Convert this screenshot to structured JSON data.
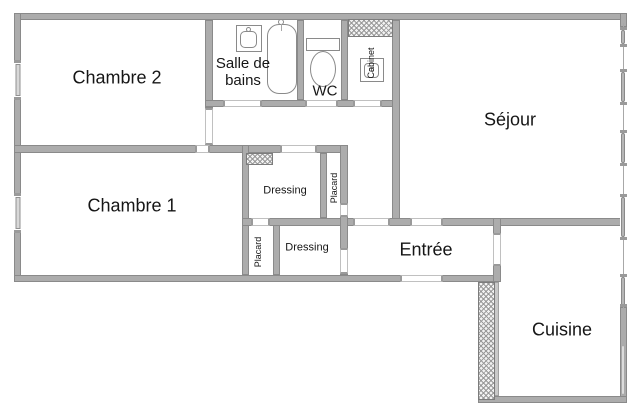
{
  "floorplan": {
    "rooms": {
      "chambre2": {
        "label": "Chambre 2"
      },
      "salle_de_bains": {
        "label_line1": "Salle de",
        "label_line2": "bains"
      },
      "wc": {
        "label": "WC"
      },
      "cabinet": {
        "label": "Cabinet"
      },
      "sejour": {
        "label": "Séjour"
      },
      "chambre1": {
        "label": "Chambre 1"
      },
      "dressing_top": {
        "label": "Dressing"
      },
      "placard_top": {
        "label": "Placard"
      },
      "placard_bottom": {
        "label": "Placard"
      },
      "dressing_bottom": {
        "label": "Dressing"
      },
      "entree": {
        "label": "Entrée"
      },
      "cuisine": {
        "label": "Cuisine"
      }
    },
    "fixtures": [
      {
        "icon": "washbasin-icon",
        "room": "salle_de_bains"
      },
      {
        "icon": "bathtub-icon",
        "room": "salle_de_bains"
      },
      {
        "icon": "toilet-icon",
        "room": "wc"
      },
      {
        "icon": "washbasin-icon",
        "room": "cabinet"
      }
    ],
    "colors": {
      "wall": "#acacac",
      "wall_edge": "#8a8a8a",
      "text": "#161616",
      "background": "#ffffff"
    }
  }
}
